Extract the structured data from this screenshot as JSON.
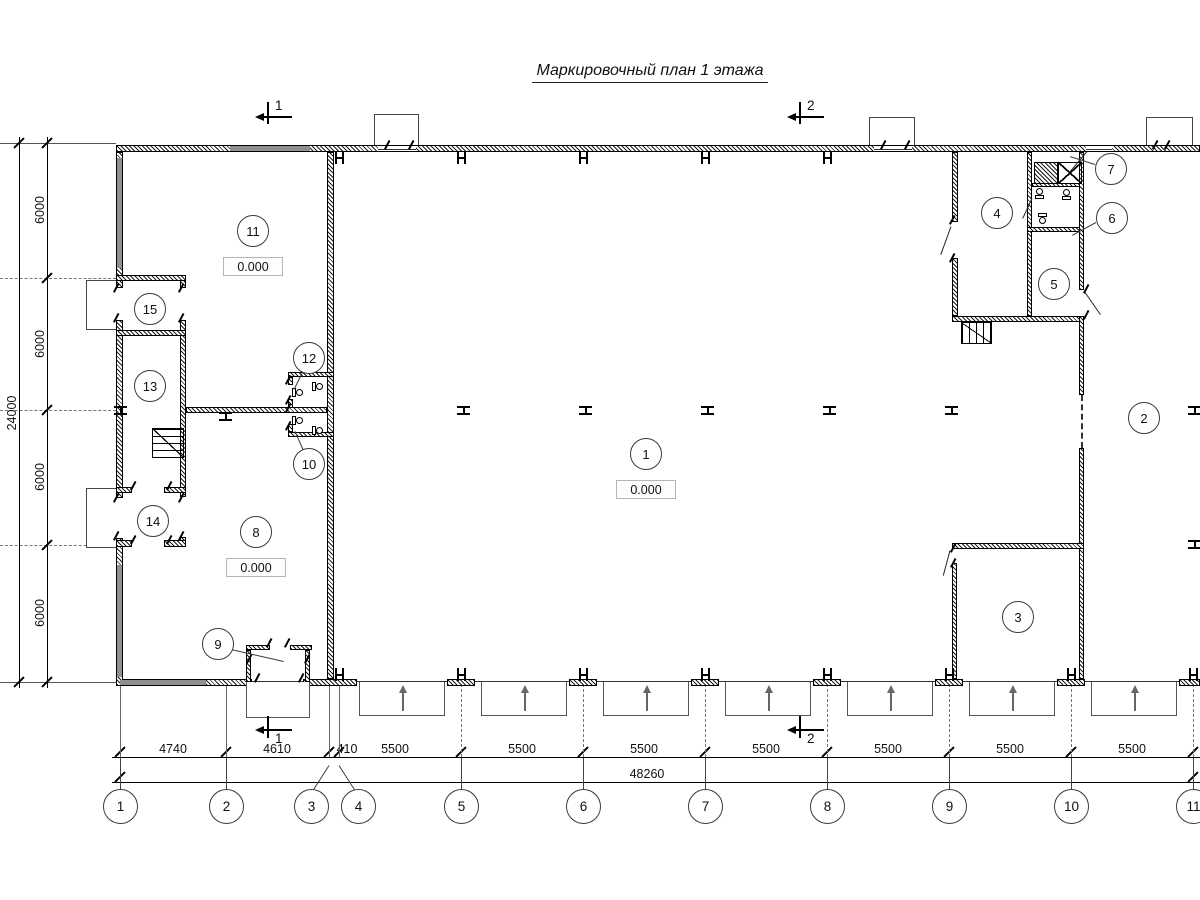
{
  "title": "Маркировочный план 1 этажа",
  "rooms": [
    "1",
    "2",
    "3",
    "4",
    "5",
    "6",
    "7",
    "8",
    "9",
    "10",
    "11",
    "12",
    "13",
    "14",
    "15"
  ],
  "elevation": {
    "hall": "0.000",
    "room11": "0.000",
    "room8": "0.000"
  },
  "axes": {
    "cols": [
      "1",
      "2",
      "3",
      "4",
      "5",
      "6",
      "7",
      "8",
      "9",
      "10",
      "11"
    ]
  },
  "dims": {
    "bottom": {
      "segments": [
        "4740",
        "4610",
        "410",
        "5500",
        "5500",
        "5500",
        "5500",
        "5500",
        "5500",
        "5500"
      ],
      "total": "48260"
    },
    "left": {
      "segments": [
        "6000",
        "6000",
        "6000",
        "6000"
      ],
      "total": "24000"
    }
  },
  "sections": {
    "s1": "1",
    "s2": "2"
  },
  "colors": {
    "line": "#000000",
    "glazing": "#8f8f8f",
    "paper": "#ffffff"
  }
}
